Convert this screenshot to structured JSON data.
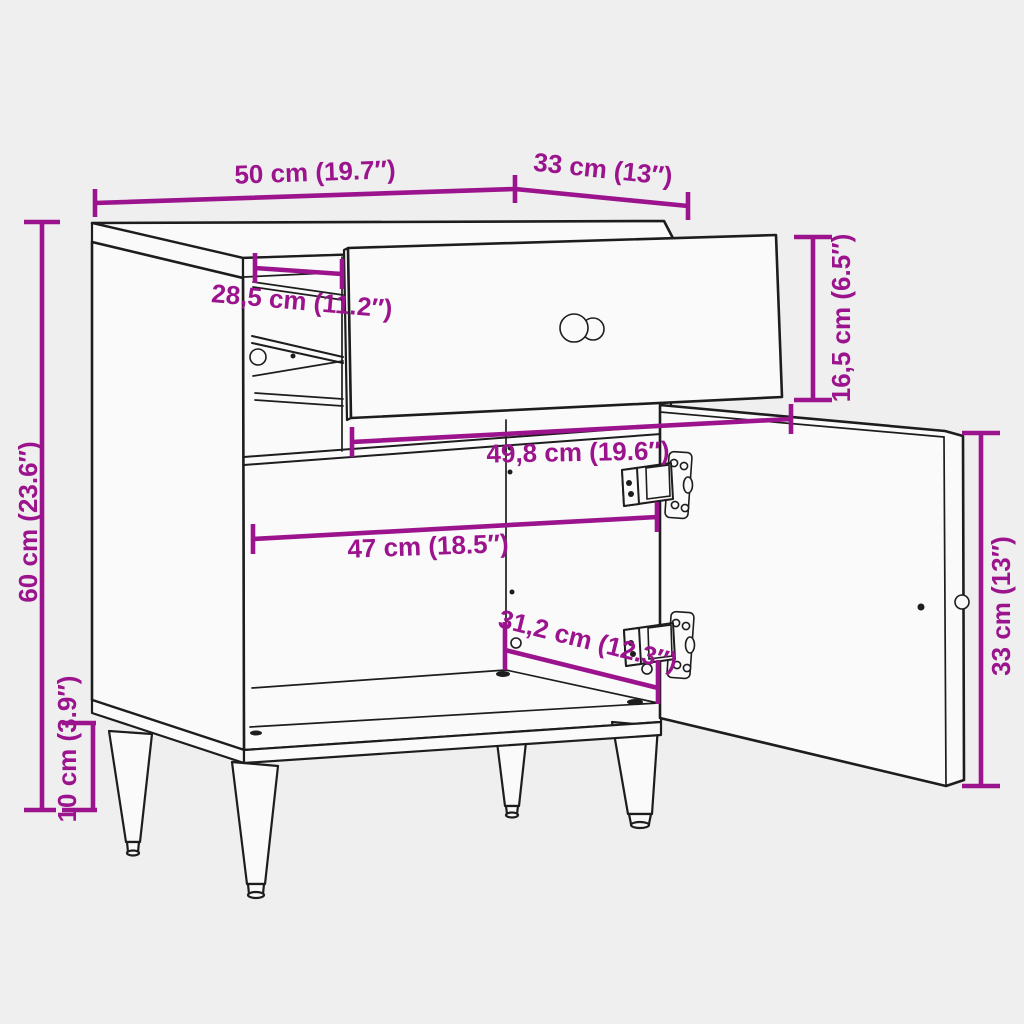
{
  "colors": {
    "accent": "#9B148D",
    "line": "#1D1D1D",
    "background": "#EFEFEF",
    "surface": "#FAFAFA"
  },
  "diagram": {
    "dimensions": {
      "top_width": "50 cm (19.7″)",
      "top_depth": "33 cm (13″)",
      "drawer_interior_depth": "28,5 cm (11.2″)",
      "drawer_front_height": "16,5 cm (6.5″)",
      "drawer_width": "49,8 cm (19.6″)",
      "interior_width": "47 cm (18.5″)",
      "interior_depth": "31,2 cm (12.3″)",
      "door_height": "33 cm (13″)",
      "total_height": "60 cm (23.6″)",
      "leg_height": "10 cm (3.9″)"
    }
  }
}
